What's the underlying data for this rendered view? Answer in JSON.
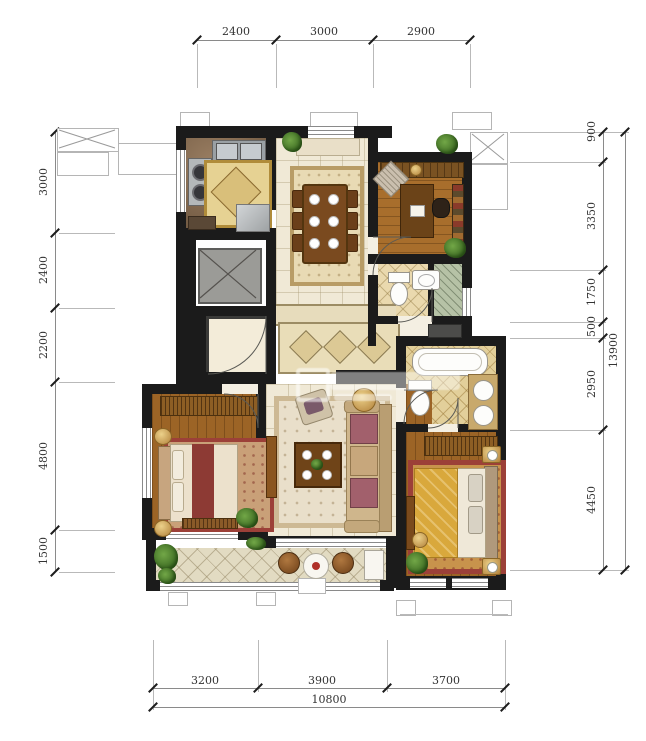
{
  "dimensions": {
    "top": [
      "2400",
      "3000",
      "2900"
    ],
    "left": [
      "3000",
      "2400",
      "2200",
      "4800",
      "1500"
    ],
    "right": [
      "900",
      "3350",
      "1750",
      "500",
      "2950",
      "4450"
    ],
    "right_total": "13900",
    "bottom": [
      "3200",
      "3900",
      "3700"
    ],
    "bottom_total": "10800"
  },
  "colors": {
    "wall": "#1b1b1b",
    "dimline": "#8a8a8a",
    "extline": "#b9b9b9",
    "dimtext": "#333333",
    "tile": "#f0e9d6",
    "balcony": "#e2dbc2",
    "bathtile": "#ead9ae",
    "goldtile": "#e2cf9a",
    "wood": "#a86e2c",
    "woodDark": "#9c6426",
    "shower": "#b6c2a6",
    "grey": "#9b9b97",
    "rugRed": "#9c4038",
    "duvet": "#d9a83c"
  }
}
